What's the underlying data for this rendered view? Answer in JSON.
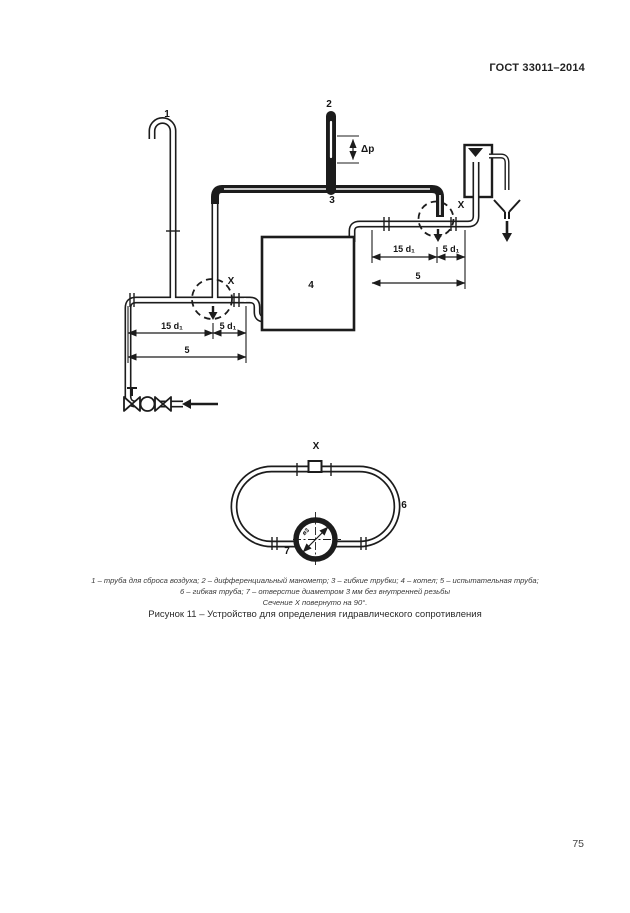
{
  "page": {
    "header": "ГОСТ 33011–2014",
    "number": "75"
  },
  "figure": {
    "caption_line1": "1 – труба для сброса воздуха; 2 – дифференциальный манометр; 3 – гибкие трубки; 4 – котел; 5 – испытательная труба;",
    "caption_line2": "6 – гибкая труба; 7 – отверстие диаметром 3 мм без внутренней резьбы",
    "caption_line3": "Сечение X повернуто на 90°.",
    "title": "Рисунок 11 – Устройство для определения гидравлического сопротивления"
  },
  "diagram": {
    "labels": {
      "item1": "1",
      "item2": "2",
      "item3": "3",
      "item4": "4",
      "item6": "6",
      "item7": "7",
      "section_x_left": "X",
      "section_x_right": "X",
      "section_x_view": "X",
      "delta_p": "Δp",
      "hole_dia": "ø3"
    },
    "dimensions": {
      "left_15d": "15 d₁",
      "left_5d": "5 d₁",
      "left_span": "5",
      "right_15d": "15 d₁",
      "right_5d": "5 d₁",
      "right_span": "5"
    }
  }
}
